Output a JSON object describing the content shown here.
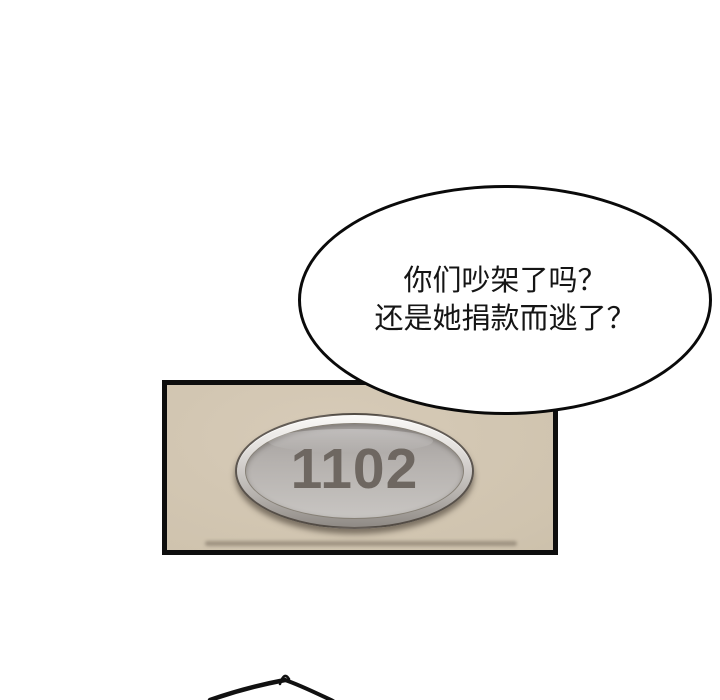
{
  "page": {
    "type": "comic-page",
    "background_color": "#ffffff"
  },
  "speech_bubble": {
    "lines": [
      "你们吵架了吗？",
      "还是她捐款而逃了？"
    ],
    "text_color": "#151515",
    "fill_color": "#ffffff",
    "outline_color": "#0a0a0a"
  },
  "door_panel": {
    "plate_number": "1102",
    "wall_color": "#cfc3ae",
    "border_color": "#0e0e0e",
    "plate_rim_color": "#e9e7e4",
    "plate_face_color": "#b5b1ae",
    "number_color": "#6e6761"
  },
  "bottom_sketch": {
    "label": "head-outline"
  }
}
